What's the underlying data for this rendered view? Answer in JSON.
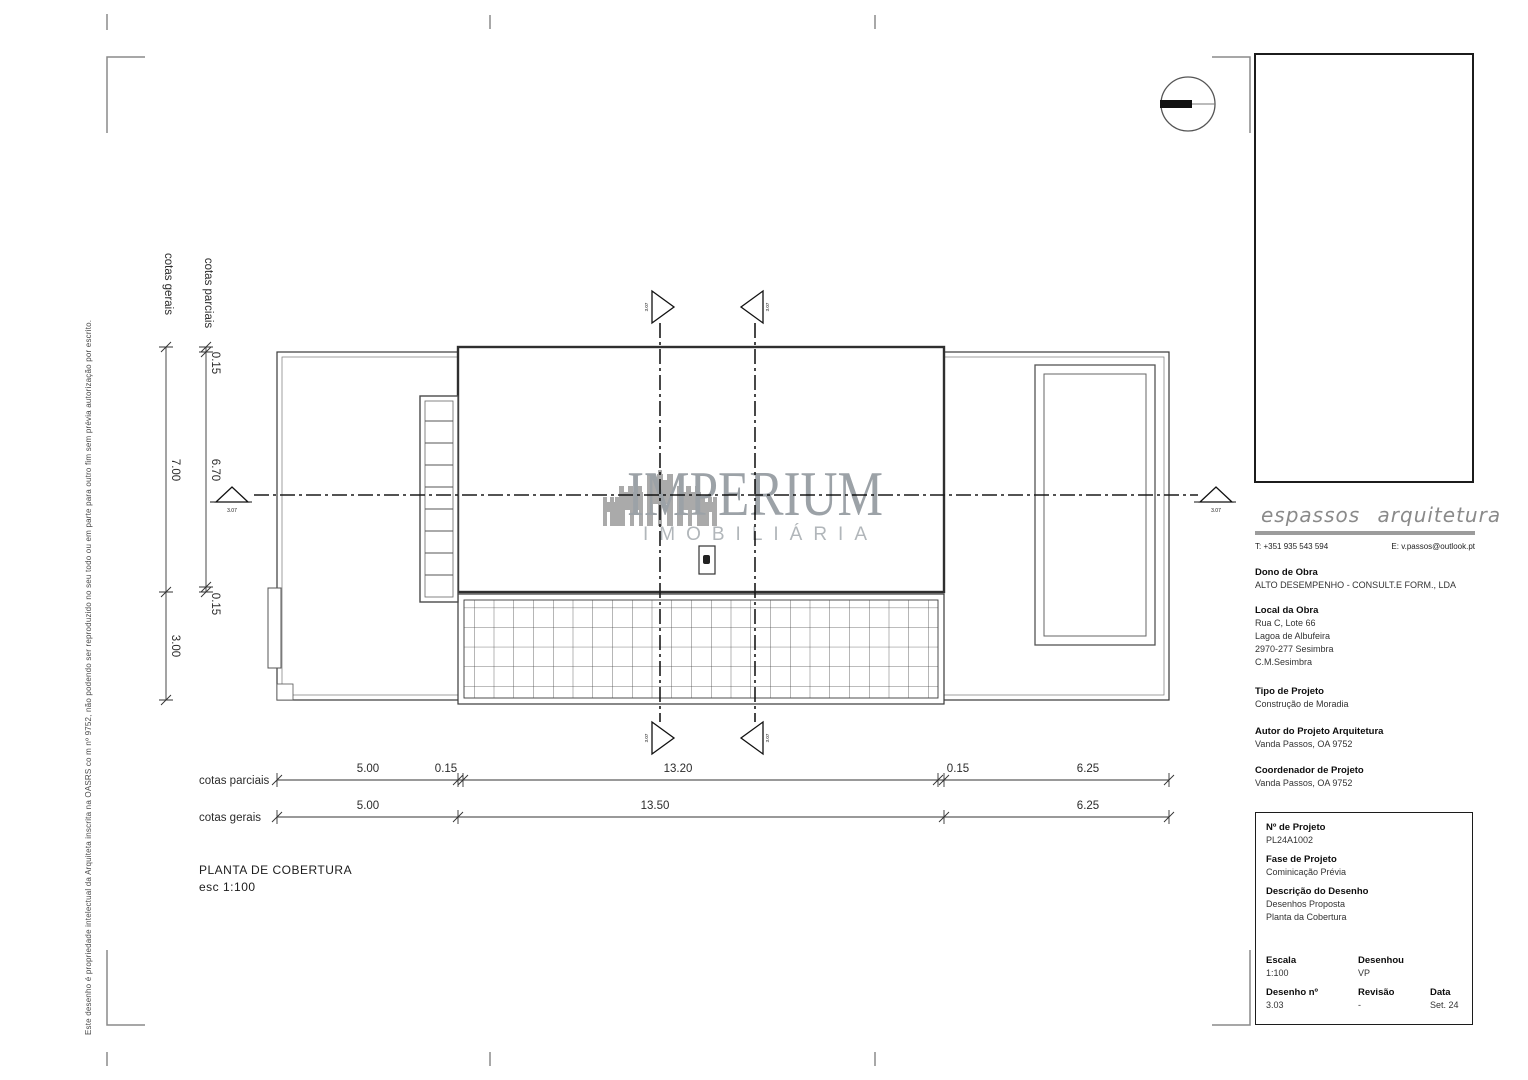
{
  "plan": {
    "title": "PLANTA DE COBERTURA",
    "scale_note": "esc 1:100"
  },
  "dims": {
    "left_gerais_label": "cotas gerais",
    "left_parciais_label": "cotas parciais",
    "bottom_parciais_label": "cotas parciais",
    "bottom_gerais_label": "cotas gerais",
    "vertical": {
      "gerais": [
        "7.00",
        "3.00"
      ],
      "parciais": [
        "0.15",
        "6.70",
        "0.15"
      ]
    },
    "horizontal": {
      "parciais": [
        "5.00",
        "0.15",
        "13.20",
        "0.15",
        "6.25"
      ],
      "gerais": [
        "5.00",
        "13.50",
        "6.25"
      ]
    },
    "section_label": "3.07"
  },
  "watermark": {
    "name": "IMPERIUM",
    "subtitle": "IMOBILIÁRIA"
  },
  "copyright_note": "Este desenho é propriedade intelectual da Arquiteta inscrita na OASRS co m nº 9752, não podendo ser reproduzido no seu todo ou em parte para outro fim sem prévia autorização por escrito.",
  "title_block": {
    "firm": "espassos arquitetura",
    "phone": "T: +351 935 543 594",
    "email": "E: v.passos@outlook.pt",
    "owner_label": "Dono de Obra",
    "owner": "ALTO DESEMPENHO - CONSULT.E FORM., LDA",
    "location_label": "Local da Obra",
    "location_lines": [
      "Rua C, Lote 66",
      "Lagoa de Albufeira",
      "2970-277 Sesimbra",
      "C.M.Sesimbra"
    ],
    "type_label": "Tipo de Projeto",
    "type": "Construção de Moradia",
    "author_label": "Autor do Projeto Arquitetura",
    "author": "Vanda Passos, OA 9752",
    "coordinator_label": "Coordenador de Projeto",
    "coordinator": "Vanda Passos, OA 9752",
    "project_no_label": "Nº de Projeto",
    "project_no": "PL24A1002",
    "phase_label": "Fase de Projeto",
    "phase": "Cominicação Prévia",
    "description_label": "Descrição do Desenho",
    "description_lines": [
      "Desenhos Proposta",
      "Planta da Cobertura"
    ],
    "scale_label": "Escala",
    "scale": "1:100",
    "drawn_label": "Desenhou",
    "drawn": "VP",
    "drawing_no_label": "Desenho nº",
    "drawing_no": "3.03",
    "revision_label": "Revisão",
    "revision": "-",
    "date_label": "Data",
    "date": "Set. 24"
  },
  "colors": {
    "line_dark": "#2f2f2f",
    "line_mid": "#4a4a4a",
    "line_light": "#777777",
    "mark_gray": "#8a8a8a",
    "watermark_gray": "#949aa0",
    "logo_gray": "#8a8a8a"
  }
}
